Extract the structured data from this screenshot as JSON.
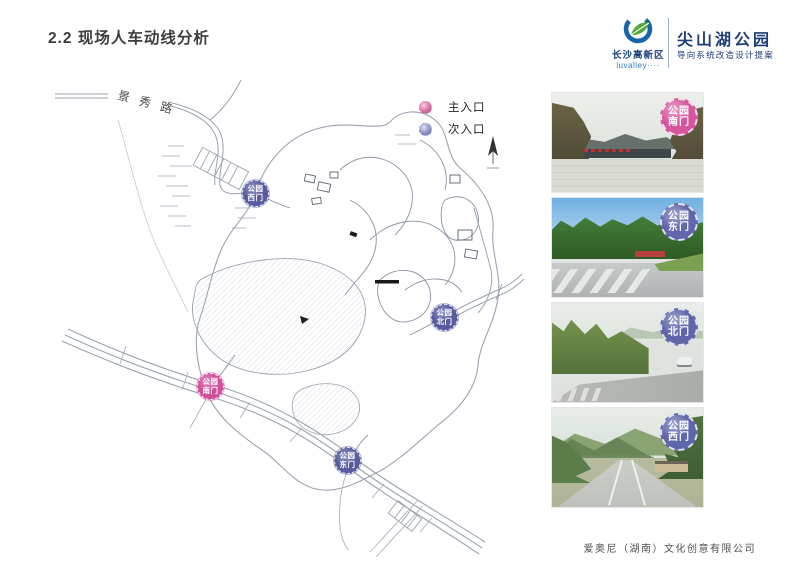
{
  "slide": {
    "title": "2.2 现场人车动线分析",
    "footer": "爱奥尼（湖南）文化创意有限公司"
  },
  "header": {
    "org_name": "长沙高新区",
    "org_tagline": "luvalley····",
    "project_name": "尖山湖公园",
    "project_subtitle": "导向系统改造设计提案"
  },
  "legend": {
    "main_entrance_label": "主入口",
    "secondary_entrance_label": "次入口"
  },
  "map": {
    "road_label": "景秀路",
    "markers": [
      {
        "line1": "公园",
        "line2": "西门",
        "type": "secondary"
      },
      {
        "line1": "公园",
        "line2": "北门",
        "type": "secondary"
      },
      {
        "line1": "公园",
        "line2": "南门",
        "type": "main"
      },
      {
        "line1": "公园",
        "line2": "东门",
        "type": "secondary"
      }
    ]
  },
  "photos": [
    {
      "badge_line1": "公园",
      "badge_line2": "南门",
      "type": "main"
    },
    {
      "badge_line1": "公园",
      "badge_line2": "东门",
      "type": "secondary"
    },
    {
      "badge_line1": "公园",
      "badge_line2": "北门",
      "type": "secondary"
    },
    {
      "badge_line1": "公园",
      "badge_line2": "西门",
      "type": "secondary"
    }
  ],
  "colors": {
    "main_entrance": "#d6569d",
    "secondary_entrance": "#6066aa",
    "brand_navy": "#1e3e78",
    "brand_blue": "#2e7cc0",
    "map_line": "#9aa3b2"
  }
}
